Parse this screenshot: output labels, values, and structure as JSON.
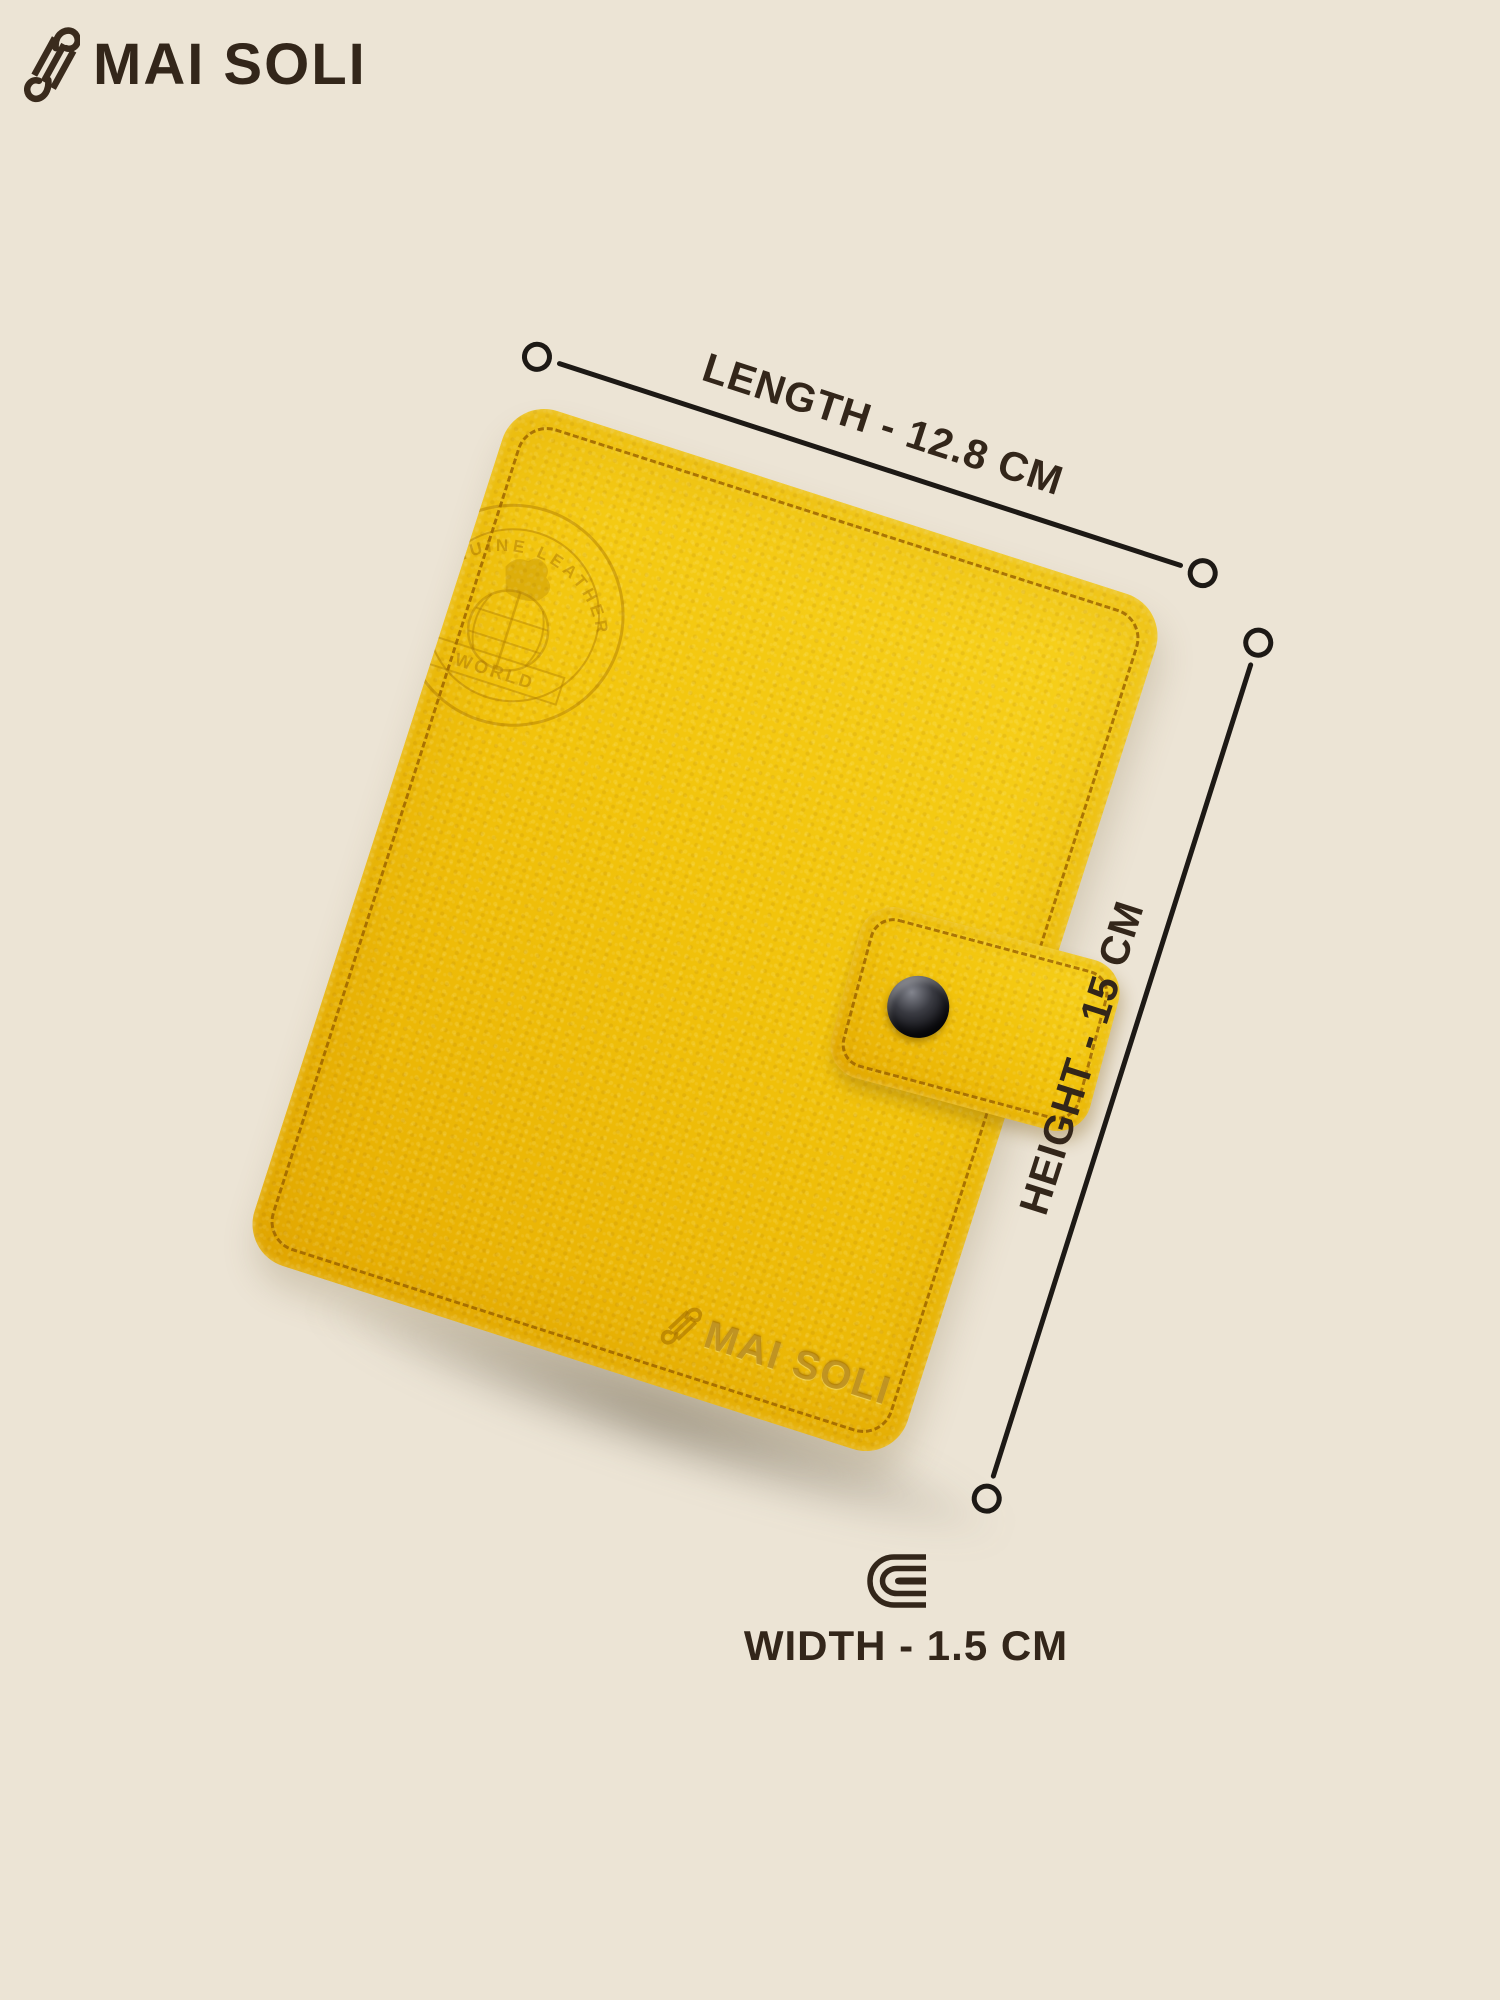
{
  "brand": {
    "name": "MAI SOLI"
  },
  "annotations": {
    "length": {
      "label": "LENGTH - 12.8 CM"
    },
    "height": {
      "label": "HEIGHT - 15 CM"
    },
    "width": {
      "label": "WIDTH - 1.5 CM"
    }
  },
  "wallet": {
    "embossed_brand": "MAI SOLI",
    "medallion": {
      "arc_text": "GENUINE LEATHER",
      "band_text": "WORLD"
    }
  },
  "colors": {
    "background": "#ece4d5",
    "leather": "#f2c40c",
    "leather_highlight": "#f8d31f",
    "leather_shadow": "#e7ae02",
    "stitch": "#96600a",
    "ink": "#33261a",
    "line": "#1d1915",
    "snap": "#0e0e12"
  }
}
